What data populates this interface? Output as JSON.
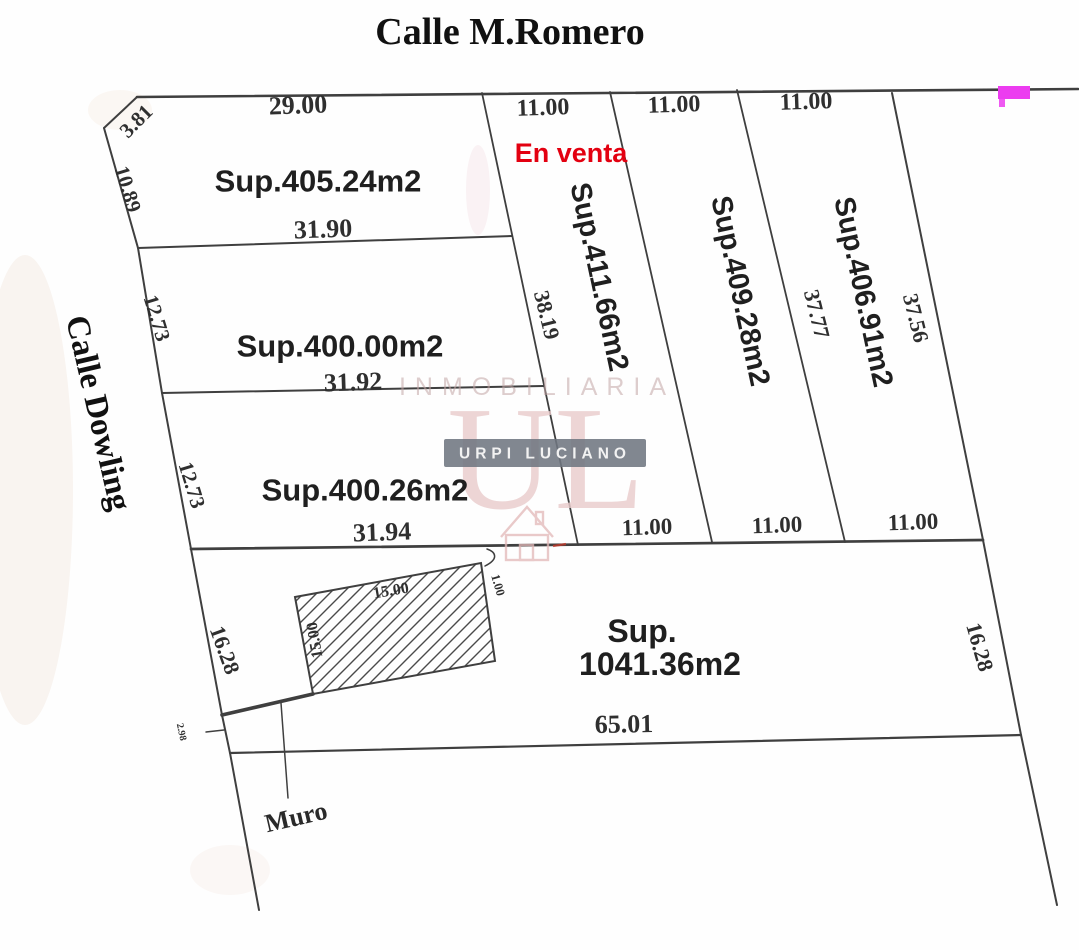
{
  "title": "Calle M.Romero",
  "street_left": "Calle Dowling",
  "status": "En venta",
  "muro_label": "Muro",
  "areas": {
    "lot1": "Sup.405.24m2",
    "lot2": "Sup.400.00m2",
    "lot3": "Sup.400.26m2",
    "lot4": "Sup.411.66m2",
    "lot5": "Sup.409.28m2",
    "lot6": "Sup.406.91m2",
    "lot7_prefix": "Sup.",
    "lot7_value": "1041.36m2"
  },
  "dims": {
    "front_29": "29.00",
    "chamfer_3_81": "3.81",
    "left_10_89": "10.89",
    "left_12_73_a": "12.73",
    "left_12_73_b": "12.73",
    "back_31_90": "31.90",
    "back_31_92": "31.92",
    "back_31_94": "31.94",
    "front_11_a": "11.00",
    "front_11_b": "11.00",
    "front_11_c": "11.00",
    "side_38_19": "38.19",
    "side_37_77": "37.77",
    "side_37_56": "37.56",
    "back_11_a": "11.00",
    "back_11_b": "11.00",
    "back_11_c": "11.00",
    "side_16_28_left": "16.28",
    "side_16_28_right": "16.28",
    "bottom_65_01": "65.01",
    "hatch_top_15": "15.00",
    "hatch_left_15": "15.00",
    "gap_1_00": "1.00",
    "gap_2_98": "2.98"
  },
  "watermark": {
    "line1": "INMOBILIARIA",
    "monogram": "UL",
    "banner": "URPI LUCIANO"
  },
  "colors": {
    "line": "#3f3f3f",
    "accent_red": "#e30010",
    "highlight_magenta": "#ec3cf0",
    "watermark_banner": "#6f7681",
    "watermark_pink": "#e9cccc"
  }
}
